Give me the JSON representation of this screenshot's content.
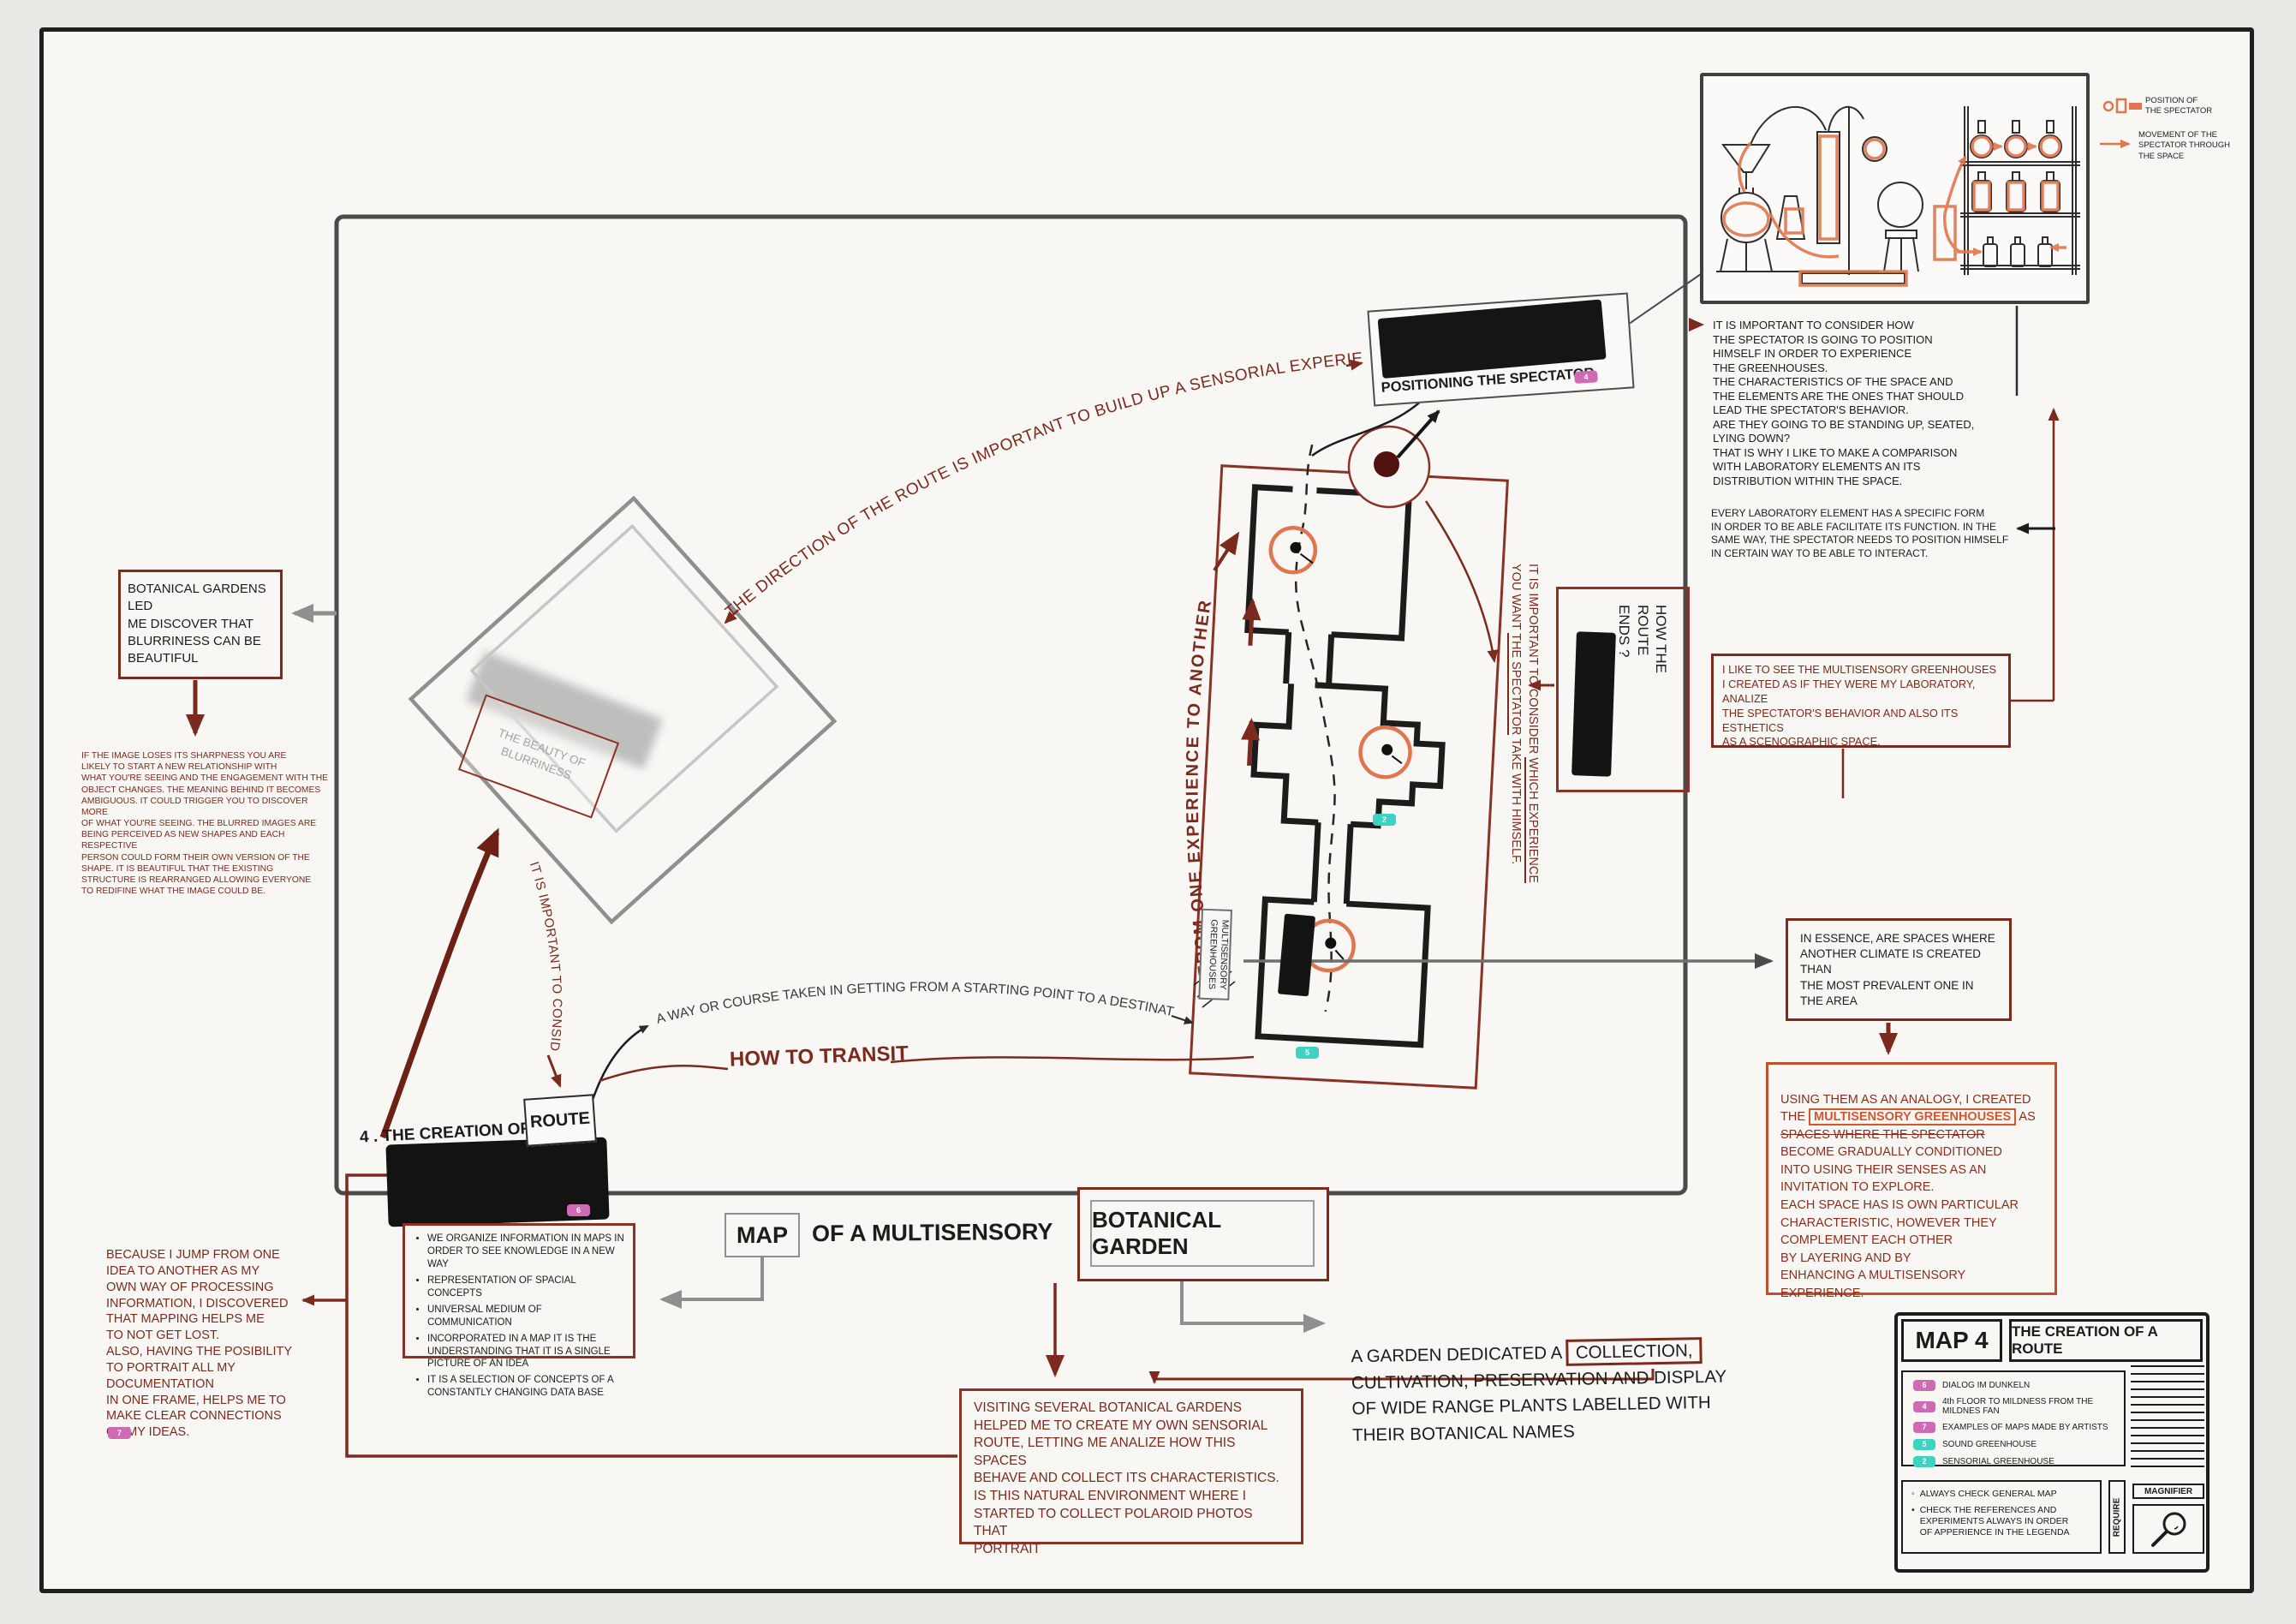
{
  "colors": {
    "dark_red": "#7b2a1d",
    "orange": "#e0764f",
    "accent_box": "#c0502c",
    "pink_badge": "#cf6ab5",
    "teal_badge": "#3ed2c3",
    "gray": "#8f8f8f",
    "black": "#1c1c1c"
  },
  "lab_legend": {
    "position": "POSITION OF\nTHE SPECTATOR",
    "movement": "MOVEMENT OF THE\nSPECTATOR THROUGH\nTHE SPACE"
  },
  "right_notes": {
    "consider_position": "IT IS IMPORTANT TO CONSIDER HOW\nTHE SPECTATOR IS GOING TO POSITION\nHIMSELF IN ORDER TO EXPERIENCE\nTHE GREENHOUSES.\nTHE CHARACTERISTICS OF THE SPACE AND\nTHE ELEMENTS ARE THE ONES THAT SHOULD\nLEAD THE SPECTATOR'S BEHAVIOR.\nARE THEY GOING TO BE STANDING UP, SEATED,\nLYING DOWN?\nTHAT IS WHY I LIKE TO MAKE A COMPARISON\nWITH LABORATORY ELEMENTS AN ITS\nDISTRIBUTION WITHIN THE SPACE.",
    "every_element": "EVERY LABORATORY ELEMENT HAS A SPECIFIC FORM\nIN ORDER TO BE ABLE FACILITATE ITS FUNCTION. IN THE\nSAME WAY, THE SPECTATOR NEEDS TO POSITION HIMSELF\nIN CERTAIN WAY TO BE ABLE TO INTERACT.",
    "like_to_see": "I LIKE TO SEE THE MULTISENSORY GREENHOUSES\nI CREATED AS IF THEY WERE MY LABORATORY, ANALIZE\nTHE SPECTATOR'S BEHAVIOR AND ALSO ITS ESTHETICS\nAS A SCENOGRAPHIC SPACE.",
    "in_essence": "IN ESSENCE, ARE SPACES WHERE\nANOTHER CLIMATE IS CREATED THAN\nTHE MOST PREVALENT ONE IN\nTHE AREA",
    "using_pre": "USING THEM AS AN ANALOGY, I CREATED\nTHE ",
    "using_highlight": "MULTISENSORY GREENHOUSES",
    "using_mid": " AS\n",
    "using_strike": "SPACES WHERE THE SPECTATOR",
    "using_post": "\nBECOME GRADUALLY CONDITIONED\nINTO USING THEIR SENSES AS AN\nINVITATION TO EXPLORE.\nEACH SPACE HAS IS OWN PARTICULAR\nCHARACTERISTIC, HOWEVER THEY\nCOMPLEMENT EACH OTHER\nBY LAYERING AND BY\nENHANCING A MULTISENSORY\nEXPERIENCE."
  },
  "annotations": {
    "direction": "THE DIRECTION OF THE ROUTE IS IMPORTANT TO BUILD UP A SENSORIAL EXPERIENCE",
    "positioning": "POSITIONING THE SPECTATOR",
    "from_one": "FROM ONE EXPERIENCE TO ANOTHER",
    "consider_l1a": "IT IS IMPORTANT TO CONSIDER ",
    "consider_l1b": "WHICH EXPERIENCE",
    "consider_l2a": "YOU WANT ",
    "consider_l2b": "THE SPECTATOR",
    "consider_l2c": " TAKE WITH HIMSELF.",
    "how_route_ends": "HOW THE\nROUTE\nENDS ?",
    "multisensory": "MULTISENSORY\nGREENHOUSES",
    "beauty": "THE BEAUTY OF\nBLURRINESS",
    "it_is_consider": "IT IS IMPORTANT TO CONSIDER",
    "creation_prefix": "4 . THE CREATION OF A",
    "route_word": "ROUTE",
    "how_to_transit": "HOW TO TRANSIT",
    "way_course": "A WAY OR COURSE TAKEN IN GETTING FROM A STARTING POINT TO A DESTINATION"
  },
  "left_notes": {
    "botanical_led": "BOTANICAL GARDENS LED\nME DISCOVER THAT\nBLURRINESS CAN BE\nBEAUTIFUL",
    "if_image": "IF THE IMAGE LOSES ITS SHARPNESS YOU ARE\nLIKELY TO START A NEW RELATIONSHIP WITH\nWHAT YOU'RE SEEING AND THE ENGAGEMENT WITH THE\nOBJECT CHANGES. THE MEANING BEHIND IT BECOMES\nAMBIGUOUS. IT COULD TRIGGER YOU TO DISCOVER MORE\nOF WHAT YOU'RE SEEING. THE BLURRED IMAGES ARE\nBEING PERCEIVED AS NEW SHAPES AND EACH RESPECTIVE\nPERSON COULD FORM THEIR OWN VERSION OF THE\nSHAPE. IT IS BEAUTIFUL THAT THE EXISTING\nSTRUCTURE IS REARRANGED ALLOWING EVERYONE\nTO REDIFINE WHAT THE IMAGE COULD BE.",
    "because": "BECAUSE I JUMP FROM ONE\nIDEA TO ANOTHER AS MY\nOWN WAY OF PROCESSING\nINFORMATION, I DISCOVERED\nTHAT MAPPING HELPS ME\nTO NOT GET LOST.\nALSO, HAVING THE POSIBILITY\nTO PORTRAIT ALL MY DOCUMENTATION\nIN ONE FRAME, HELPS ME TO\nMAKE CLEAR CONNECTIONS\nOF MY IDEAS."
  },
  "map_notes": [
    "WE ORGANIZE INFORMATION IN MAPS IN ORDER TO SEE KNOWLEDGE IN A NEW WAY",
    "REPRESENTATION OF SPACIAL CONCEPTS",
    "UNIVERSAL MEDIUM OF COMMUNICATION",
    "INCORPORATED IN A MAP IT IS THE UNDERSTANDING THAT IT IS A SINGLE PICTURE OF AN IDEA",
    "IT IS A SELECTION OF CONCEPTS OF A CONSTANTLY CHANGING DATA BASE"
  ],
  "title": {
    "map": "MAP",
    "of_a": "OF A MULTISENSORY",
    "botanical_garden": "BOTANICAL GARDEN"
  },
  "garden": {
    "def_pre": "A GARDEN DEDICATED A ",
    "def_boxed": "COLLECTION,",
    "def_rest": "\nCULTIVATION, PRESERVATION AND DISPLAY\nOF WIDE RANGE PLANTS LABELLED WITH\nTHEIR BOTANICAL NAMES",
    "visiting": "VISITING SEVERAL BOTANICAL GARDENS\nHELPED ME TO CREATE MY OWN SENSORIAL\nROUTE, LETTING ME ANALIZE HOW THIS SPACES\nBEHAVE AND COLLECT ITS CHARACTERISTICS.\nIS THIS NATURAL ENVIRONMENT WHERE I\nSTARTED TO COLLECT POLAROID PHOTOS THAT\nPORTRAIT"
  },
  "badges": {
    "positioning": "4",
    "route": "6",
    "because": "7",
    "sensorial": "2",
    "sound": "5"
  },
  "panel": {
    "map_no": "MAP 4",
    "title": "THE CREATION OF A ROUTE",
    "legend": [
      {
        "num": "6",
        "label": "DIALOG IM DUNKELN"
      },
      {
        "num": "4",
        "label": "4th FLOOR TO MILDNESS FROM THE MILDNES FAN"
      },
      {
        "num": "7",
        "label": "EXAMPLES OF MAPS MADE BY ARTISTS"
      },
      {
        "num": "5",
        "label": "SOUND GREENHOUSE"
      },
      {
        "num": "2",
        "label": "SENSORIAL GREENHOUSE"
      }
    ],
    "note1": "ALWAYS CHECK GENERAL MAP",
    "note2": "CHECK THE REFERENCES AND\nEXPERIMENTS ALWAYS IN ORDER\nOF APPERIENCE IN THE LEGENDA",
    "require": "REQUIRE",
    "magnifier": "MAGNIFIER"
  }
}
